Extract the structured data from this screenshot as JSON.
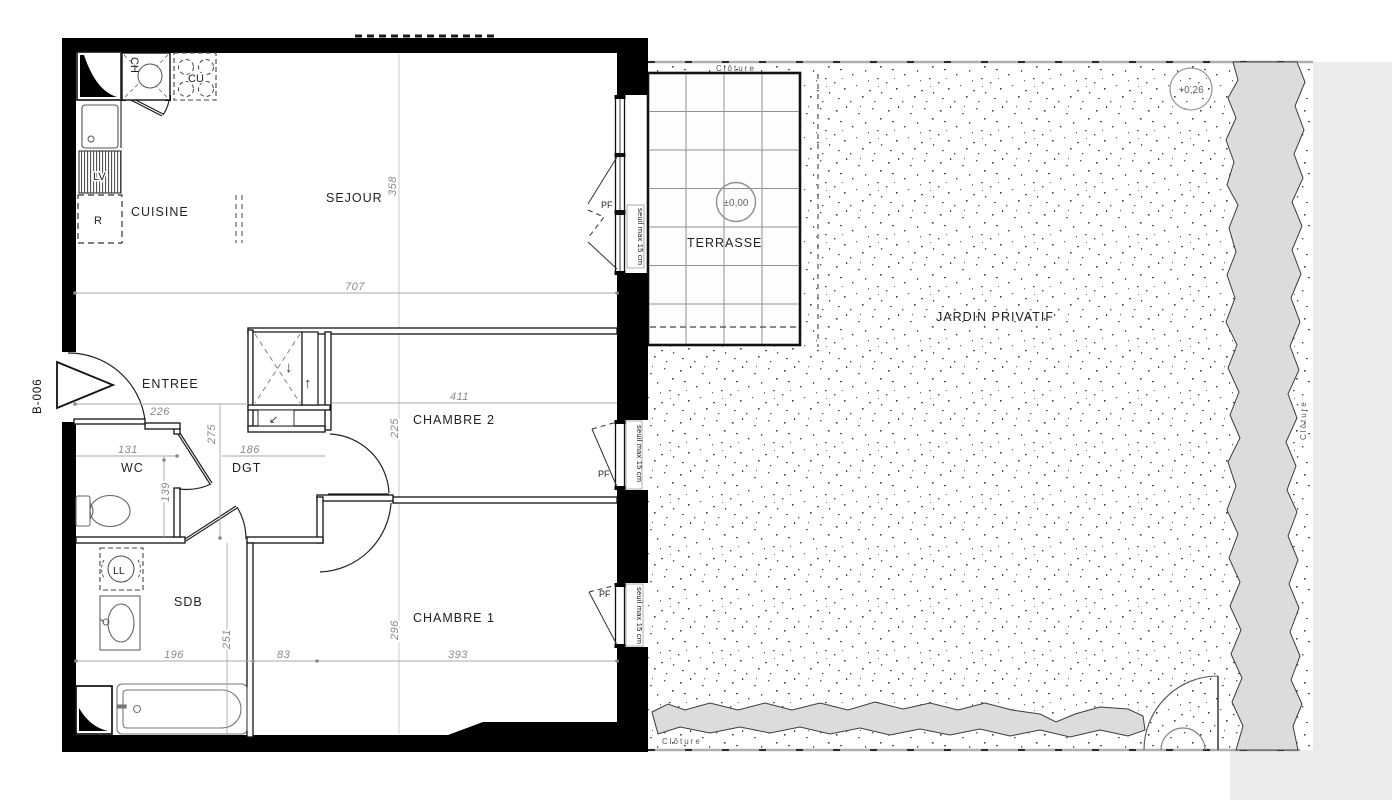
{
  "plan": {
    "ref": "B-006",
    "rooms": {
      "kitchen": "CUISINE",
      "living": "SEJOUR",
      "entry": "ENTREE",
      "wc": "WC",
      "hall": "DGT",
      "bathroom": "SDB",
      "bedroom2": "CHAMBRE 2",
      "bedroom1": "CHAMBRE 1"
    },
    "outdoor": {
      "terrace": "TERRASSE",
      "garden": "JARDIN PRIVATIF",
      "fence": "Clôture",
      "terrace_level": "±0,00",
      "garden_level": "+0,26"
    },
    "appliances": {
      "dishwasher": "LV",
      "fridge": "R",
      "boiler": "CH",
      "cooktop": "CU",
      "washer": "LL"
    },
    "openings": {
      "french_window": "PF",
      "threshold": "seuil max 15 cm",
      "duct_down": "↓",
      "duct_up": "↑",
      "duct_diag": "↙"
    },
    "dimensions_cm": {
      "living_width": "707",
      "living_depth": "358",
      "entry_width": "226",
      "hall_depth": "275",
      "wc_width": "131",
      "hall_width": "186",
      "wc_depth": "139",
      "bedroom2_width": "411",
      "bedroom2_depth": "225",
      "bath_width": "196",
      "bath_depth": "251",
      "alcove_width": "83",
      "bedroom1_depth": "296",
      "bedroom1_width": "393"
    }
  }
}
